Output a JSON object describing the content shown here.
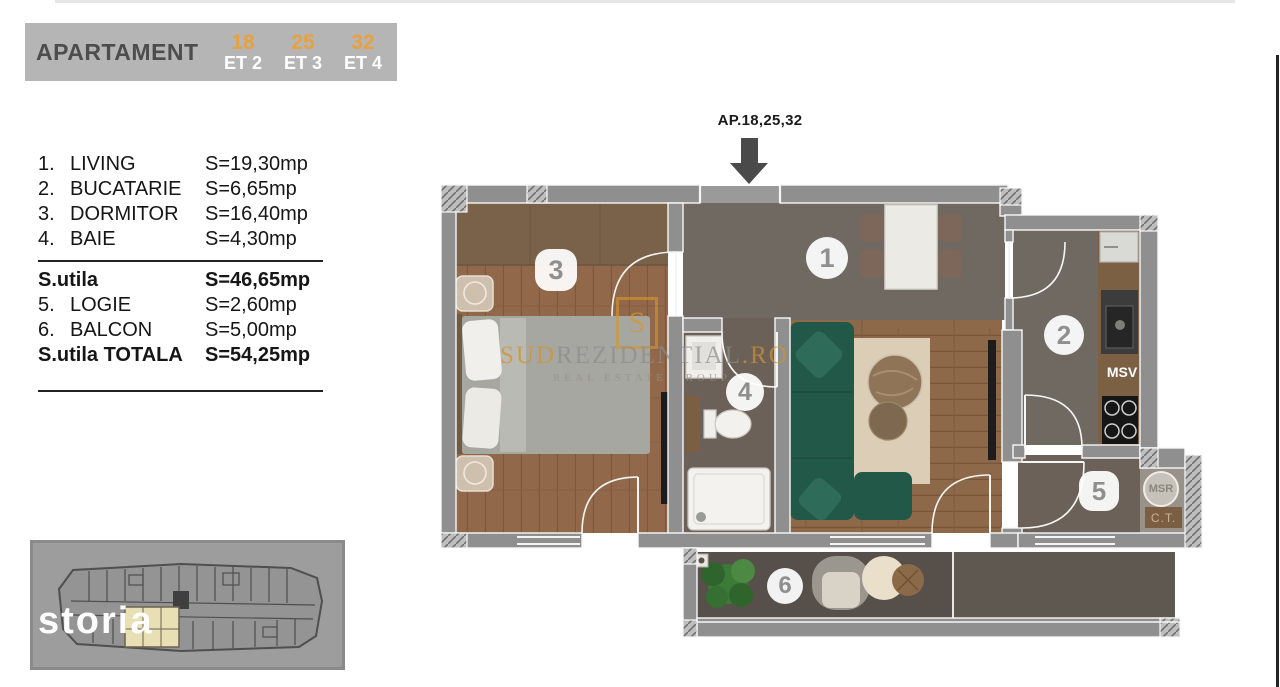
{
  "header": {
    "title": "APARTAMENT",
    "units": [
      {
        "number": "18",
        "floor": "ET 2"
      },
      {
        "number": "25",
        "floor": "ET 3"
      },
      {
        "number": "32",
        "floor": "ET 4"
      }
    ]
  },
  "legend": {
    "rows": [
      {
        "no": "1.",
        "name": "LIVING",
        "area": "S=19,30mp"
      },
      {
        "no": "2.",
        "name": "BUCATARIE",
        "area": "S=6,65mp"
      },
      {
        "no": "3.",
        "name": "DORMITOR",
        "area": "S=16,40mp"
      },
      {
        "no": "4.",
        "name": "BAIE",
        "area": "S=4,30mp"
      }
    ],
    "subtotal": {
      "name": "S.utila",
      "area": "S=46,65mp"
    },
    "rows2": [
      {
        "no": "5.",
        "name": "LOGIE",
        "area": "S=2,60mp"
      },
      {
        "no": "6.",
        "name": "BALCON",
        "area": "S=5,00mp"
      }
    ],
    "total": {
      "name": "S.utila TOTALA",
      "area": "S=54,25mp"
    }
  },
  "plan": {
    "entrance_label": "AP.18,25,32",
    "badges": [
      "1",
      "2",
      "3",
      "4",
      "5",
      "6"
    ],
    "labels": {
      "msv": "MSV",
      "msr": "MSR",
      "ct": "C.T."
    }
  },
  "watermark": {
    "logo_letter": "S",
    "part_orange_1": "SUD",
    "part_gray": "REZIDENTIAL",
    "part_orange_2": ".RO",
    "tagline": "REAL ESTATE GROUP"
  },
  "minimap": {
    "logo": "storia"
  },
  "colors": {
    "accent_orange": "#e8a13c",
    "header_gray": "#b5b5b5",
    "wall_gray": "#8f8f8f",
    "wood_floor": "#91684a",
    "sofa_green": "#215848",
    "balcony_floor": "#57504a"
  }
}
